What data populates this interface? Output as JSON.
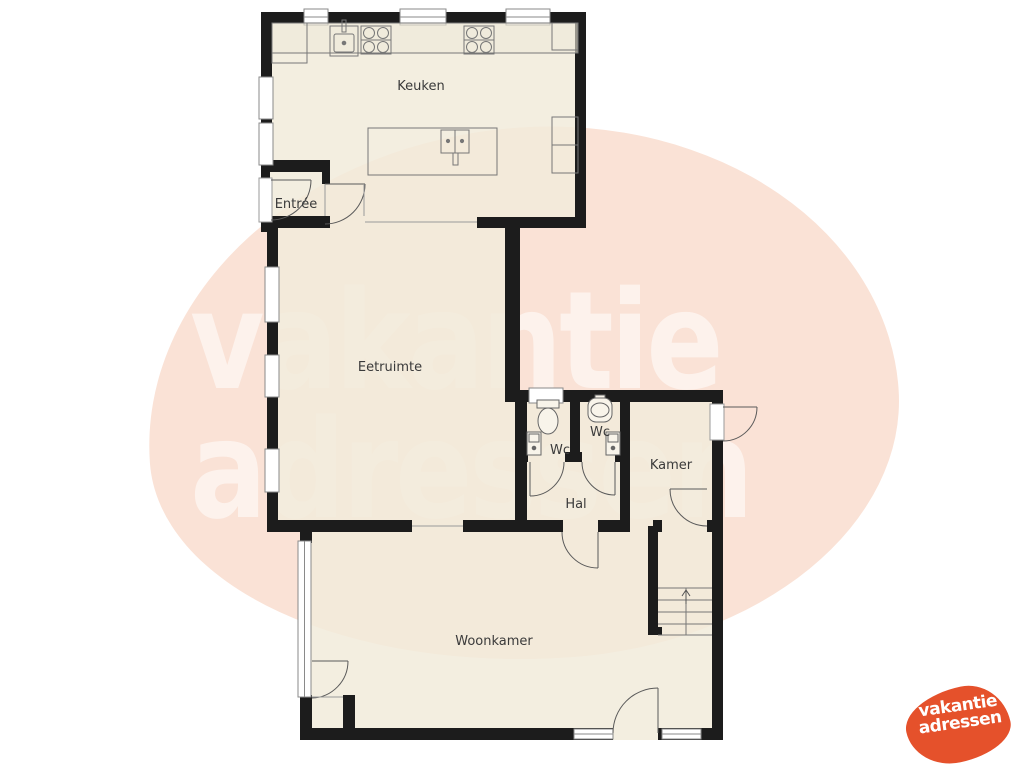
{
  "watermark": {
    "line1": "vakantie",
    "line2": "adressen"
  },
  "logo": {
    "line1": "vakantie",
    "line2": "adressen"
  },
  "rooms": {
    "keuken": "Keuken",
    "entree": "Entrée",
    "eetruimte": "Eetruimte",
    "wc_left": "Wc",
    "wc_right": "Wc",
    "kamer": "Kamer",
    "hal": "Hal",
    "woonkamer": "Woonkamer"
  },
  "colors": {
    "background": "#ffffff",
    "blob_pink": "#fae2d6",
    "floor_cream": "#f1ebdb",
    "wall_black": "#1c1c1c",
    "thin_line_gray": "#707070",
    "logo_orange": "#e5512b",
    "label_text": "#3a3a3a",
    "watermark_white": "#ffffff"
  }
}
